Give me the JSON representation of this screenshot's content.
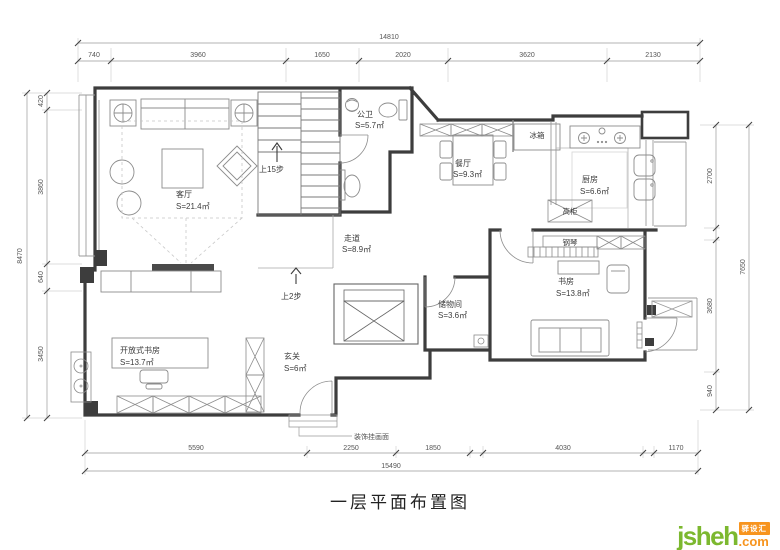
{
  "title": "一层平面布置图",
  "logo": {
    "brand": "jsheh",
    "tld": ".com",
    "badge": "驿设汇"
  },
  "dimensions": {
    "top_total": "14810",
    "top_segments": [
      "740",
      "3960",
      "1650",
      "2020",
      "3620",
      "2130"
    ],
    "left_total": "8470",
    "left_segments": [
      "420",
      "3860",
      "640",
      "3450"
    ],
    "right_total": "7650",
    "right_segments": [
      "2700",
      "3680",
      "940"
    ],
    "bottom_total": "15490",
    "bottom_segments": [
      "5590",
      "2250",
      "1850",
      "4030",
      "1170"
    ]
  },
  "rooms": [
    {
      "id": "living",
      "name": "客厅",
      "area": "S=21.4㎡"
    },
    {
      "id": "guest-bath",
      "name": "公卫",
      "area": "S=5.7㎡"
    },
    {
      "id": "dining",
      "name": "餐厅",
      "area": "S=9.3㎡"
    },
    {
      "id": "kitchen",
      "name": "厨房",
      "area": "S=6.6㎡"
    },
    {
      "id": "corridor",
      "name": "走道",
      "area": "S=8.9㎡"
    },
    {
      "id": "study",
      "name": "书房",
      "area": "S=13.8㎡"
    },
    {
      "id": "storage",
      "name": "储物间",
      "area": "S=3.6㎡"
    },
    {
      "id": "entry",
      "name": "玄关",
      "area": "S=6㎡"
    },
    {
      "id": "open-study",
      "name": "开放式书房",
      "area": "S=13.7㎡"
    }
  ],
  "annotations": {
    "stairs_up": "上15步",
    "steps_up": "上2步",
    "fridge": "冰箱",
    "tall_cabinet": "高柜",
    "piano": "钢琴",
    "decor_wall": "装饰挂画面"
  }
}
